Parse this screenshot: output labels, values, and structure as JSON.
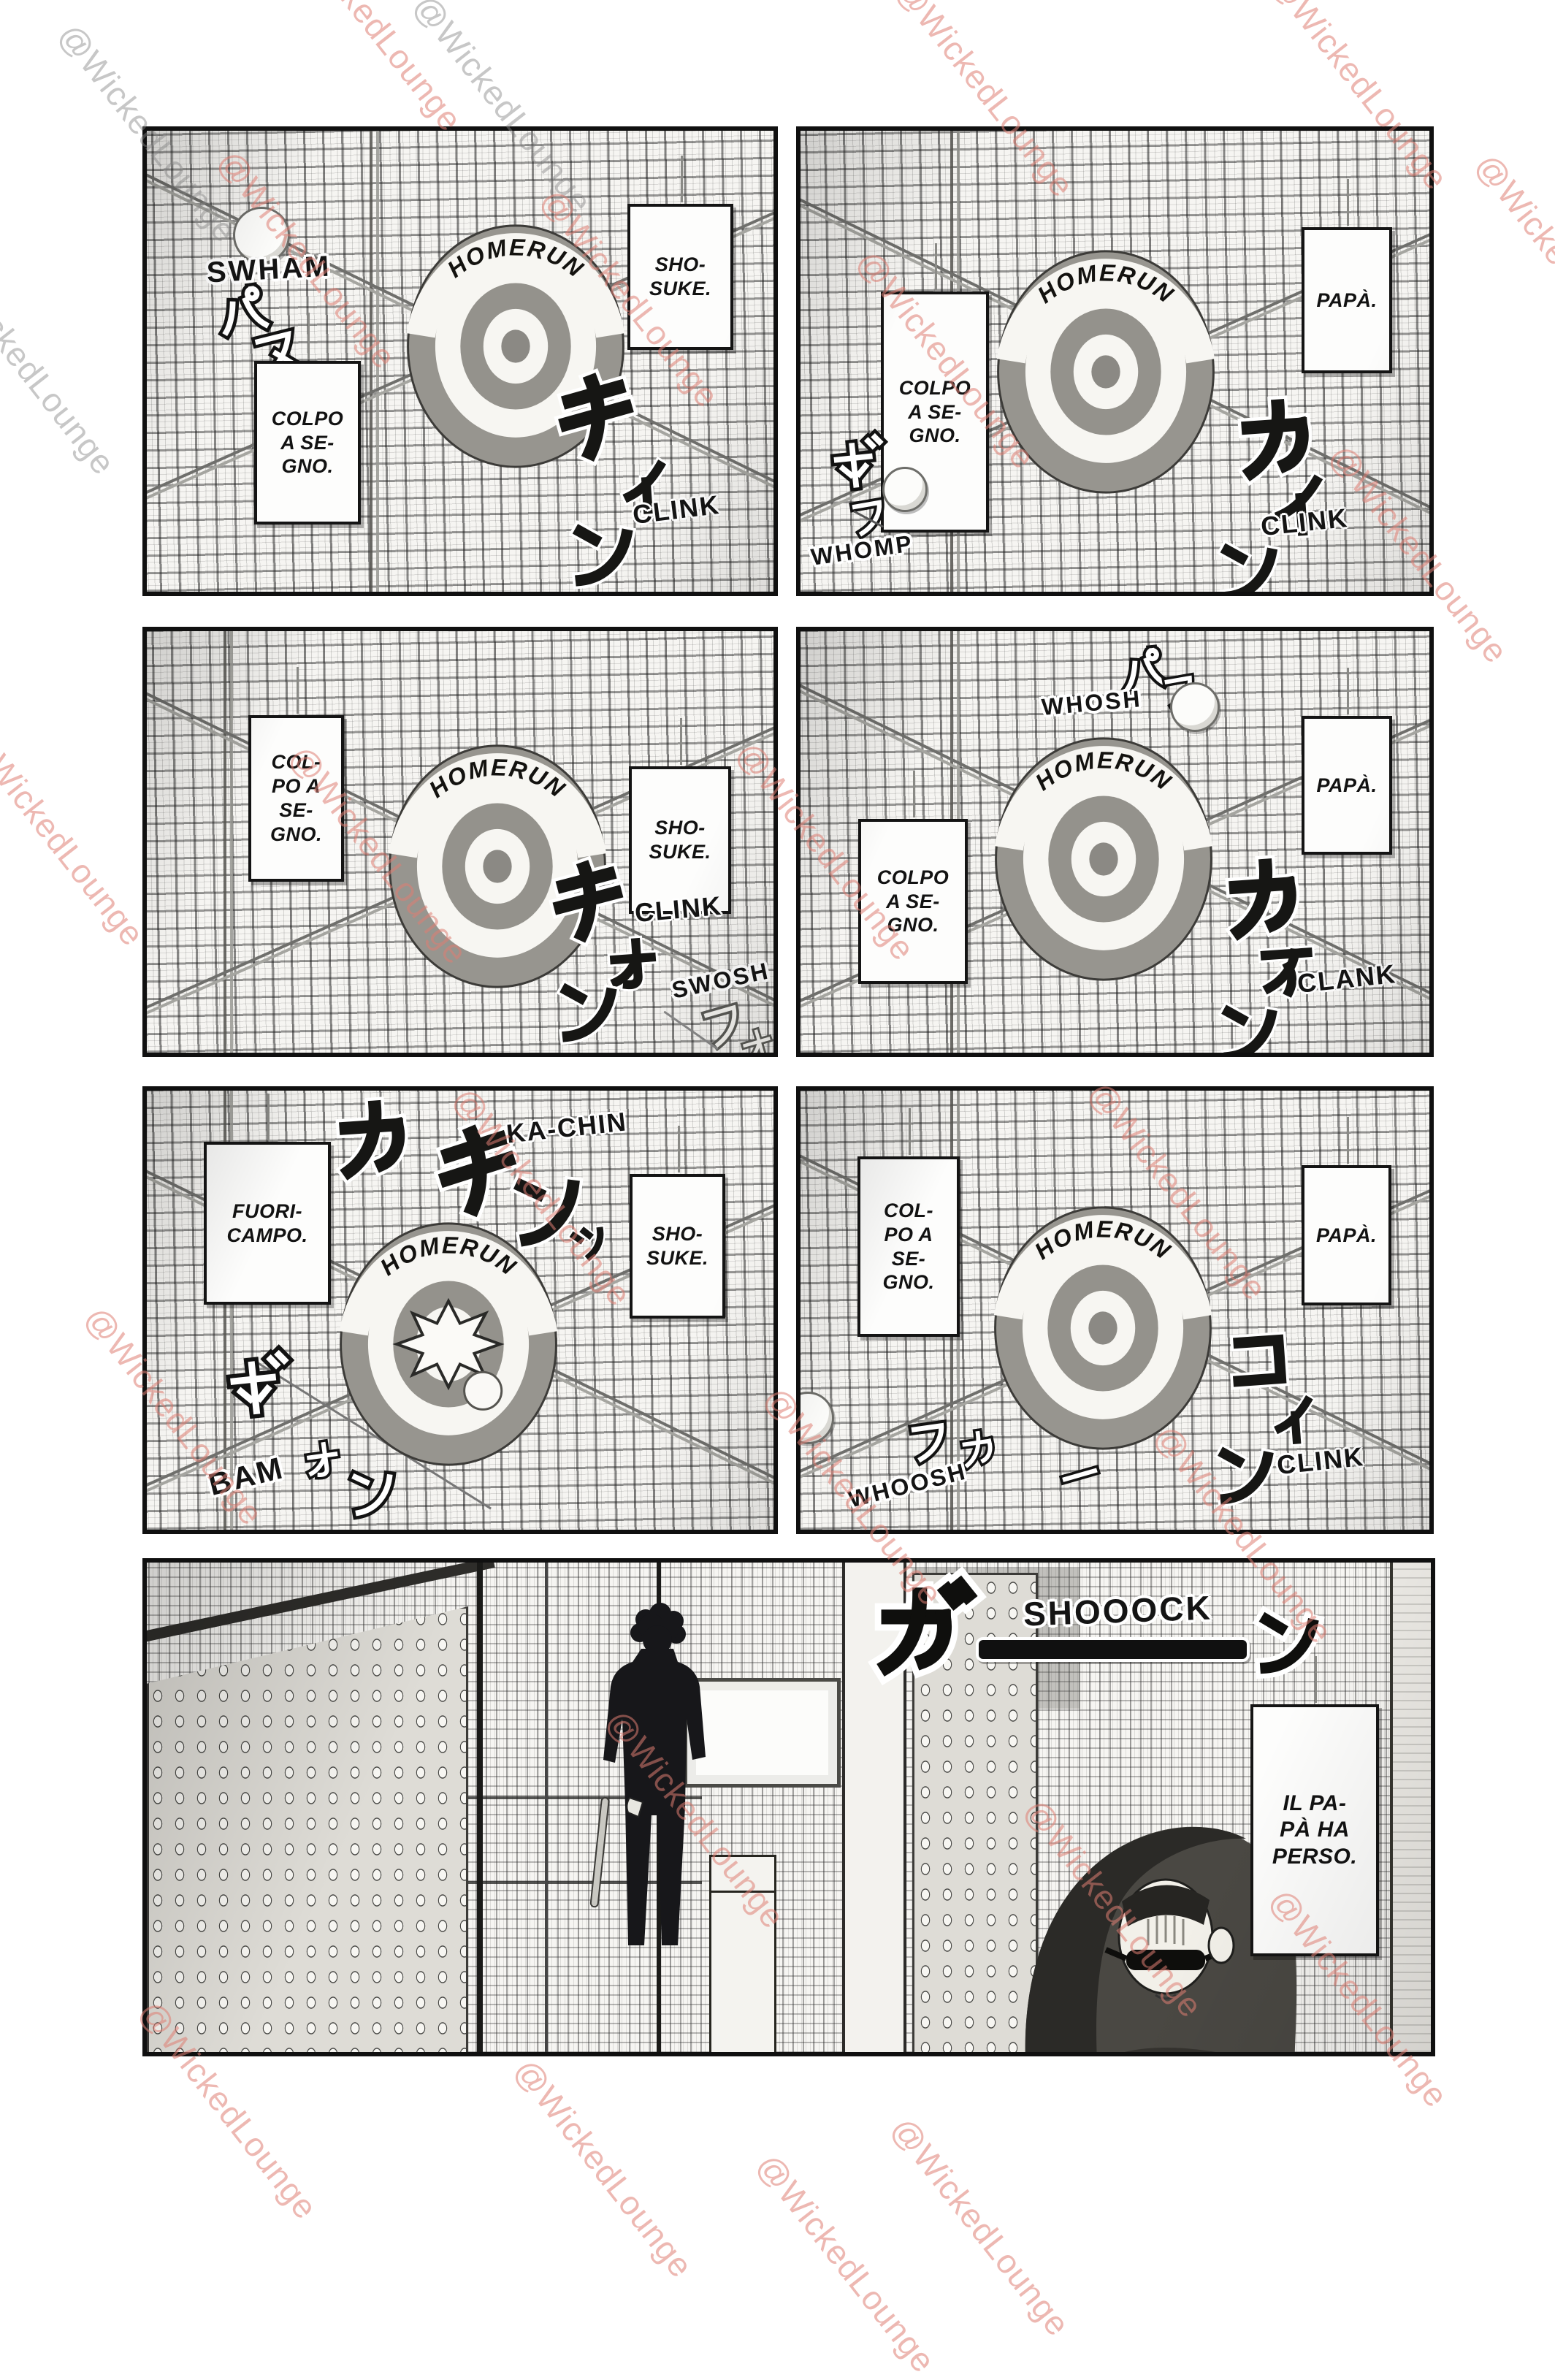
{
  "watermark": {
    "text": "@WickedLounge"
  },
  "target_label": "HOMERUN",
  "panels": {
    "p1": {
      "sfx_swing_en": "SWHAM",
      "sfx_swing_jp": [
        "パ",
        "ス"
      ],
      "box_left": "COLPO\nA SE-\nGNO.",
      "box_right": "SHO-\nSUKE.",
      "sfx_hit_jp": [
        "キ",
        "ィ",
        "ン"
      ],
      "sfx_hit_en": "CLINK"
    },
    "p2": {
      "box_left": "COLPO\nA SE-\nGNO.",
      "box_right": "PAPÀ.",
      "sfx_hit_jp": [
        "カ",
        "イ",
        "ン"
      ],
      "sfx_hit_en": "CLINK",
      "sfx_throw_jp": [
        "ボ",
        "フ"
      ],
      "sfx_throw_en": "WHOMP"
    },
    "p3": {
      "box_left": "COL-\nPO A\nSE-\nGNO.",
      "box_right": "SHO-\nSUKE.",
      "sfx_hit_jp": [
        "キ",
        "ォ",
        "ン"
      ],
      "sfx_hit_en": "CLINK",
      "sfx_miss_jp": [
        "フ",
        "ォ"
      ],
      "sfx_miss_en": "SWOSH"
    },
    "p4": {
      "sfx_throw_jp": [
        "パ",
        "フ"
      ],
      "sfx_throw_en": "WHOSH",
      "box_left": "COLPO\nA SE-\nGNO.",
      "box_right": "PAPÀ.",
      "sfx_hit_jp": [
        "カ",
        "ァ",
        "ン"
      ],
      "sfx_hit_en": "CLANK"
    },
    "p5": {
      "sfx_hit_jp": [
        "カ",
        "キ",
        "ン",
        "ッ"
      ],
      "sfx_hit_en": "KA-CHIN",
      "box_left": "FUORI-\nCAMPO.",
      "box_right": "SHO-\nSUKE.",
      "sfx_bounce_jp": [
        "ボ",
        "ォ",
        "ン"
      ],
      "sfx_bounce_en": "BAM"
    },
    "p6": {
      "box_left": "COL-\nPO A\nSE-\nGNO.",
      "box_right": "PAPÀ.",
      "sfx_hit_jp": [
        "コ",
        "ィ",
        "ン"
      ],
      "sfx_hit_en": "CLINK",
      "sfx_miss_jp": [
        "フ",
        "カ",
        "ー"
      ],
      "sfx_miss_en": "WHOOSH"
    },
    "p7": {
      "sfx_shock_jp": [
        "ガ",
        "ン"
      ],
      "sfx_shock_en": "SHOOOCK",
      "box_right": "IL PA-\nPÀ HA\nPERSO."
    }
  }
}
